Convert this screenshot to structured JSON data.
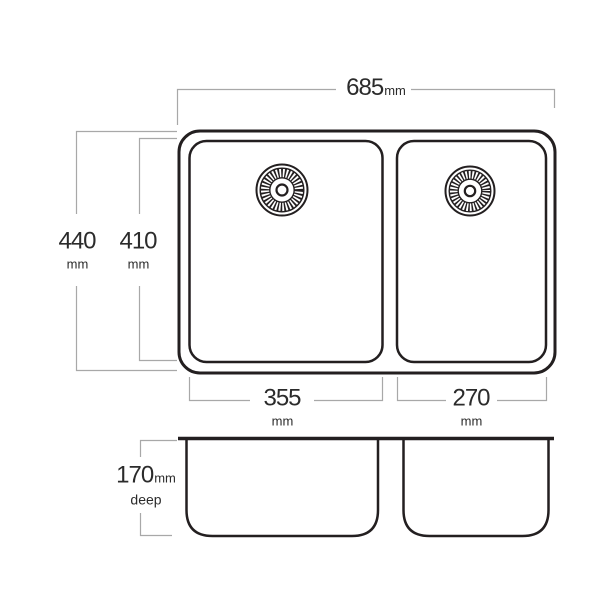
{
  "diagram": {
    "subject": "double bowl sink dimension drawing",
    "dimensions": {
      "overall_width": {
        "value": "685",
        "unit": "mm"
      },
      "overall_depth": {
        "value": "440",
        "unit": "mm"
      },
      "bowl_inner_depth": {
        "value": "410",
        "unit": "mm"
      },
      "left_bowl_width": {
        "value": "355",
        "unit": "mm"
      },
      "right_bowl_width": {
        "value": "270",
        "unit": "mm"
      },
      "bowl_depth": {
        "value": "170",
        "unit": "mm",
        "qualifier": "deep"
      }
    },
    "icons": {
      "left_drain": "drain-icon",
      "right_drain": "drain-icon"
    },
    "colors": {
      "line": "#231f20",
      "dimension_line": "#a8a8a8",
      "text": "#2b2b2b",
      "background": "#ffffff"
    }
  }
}
